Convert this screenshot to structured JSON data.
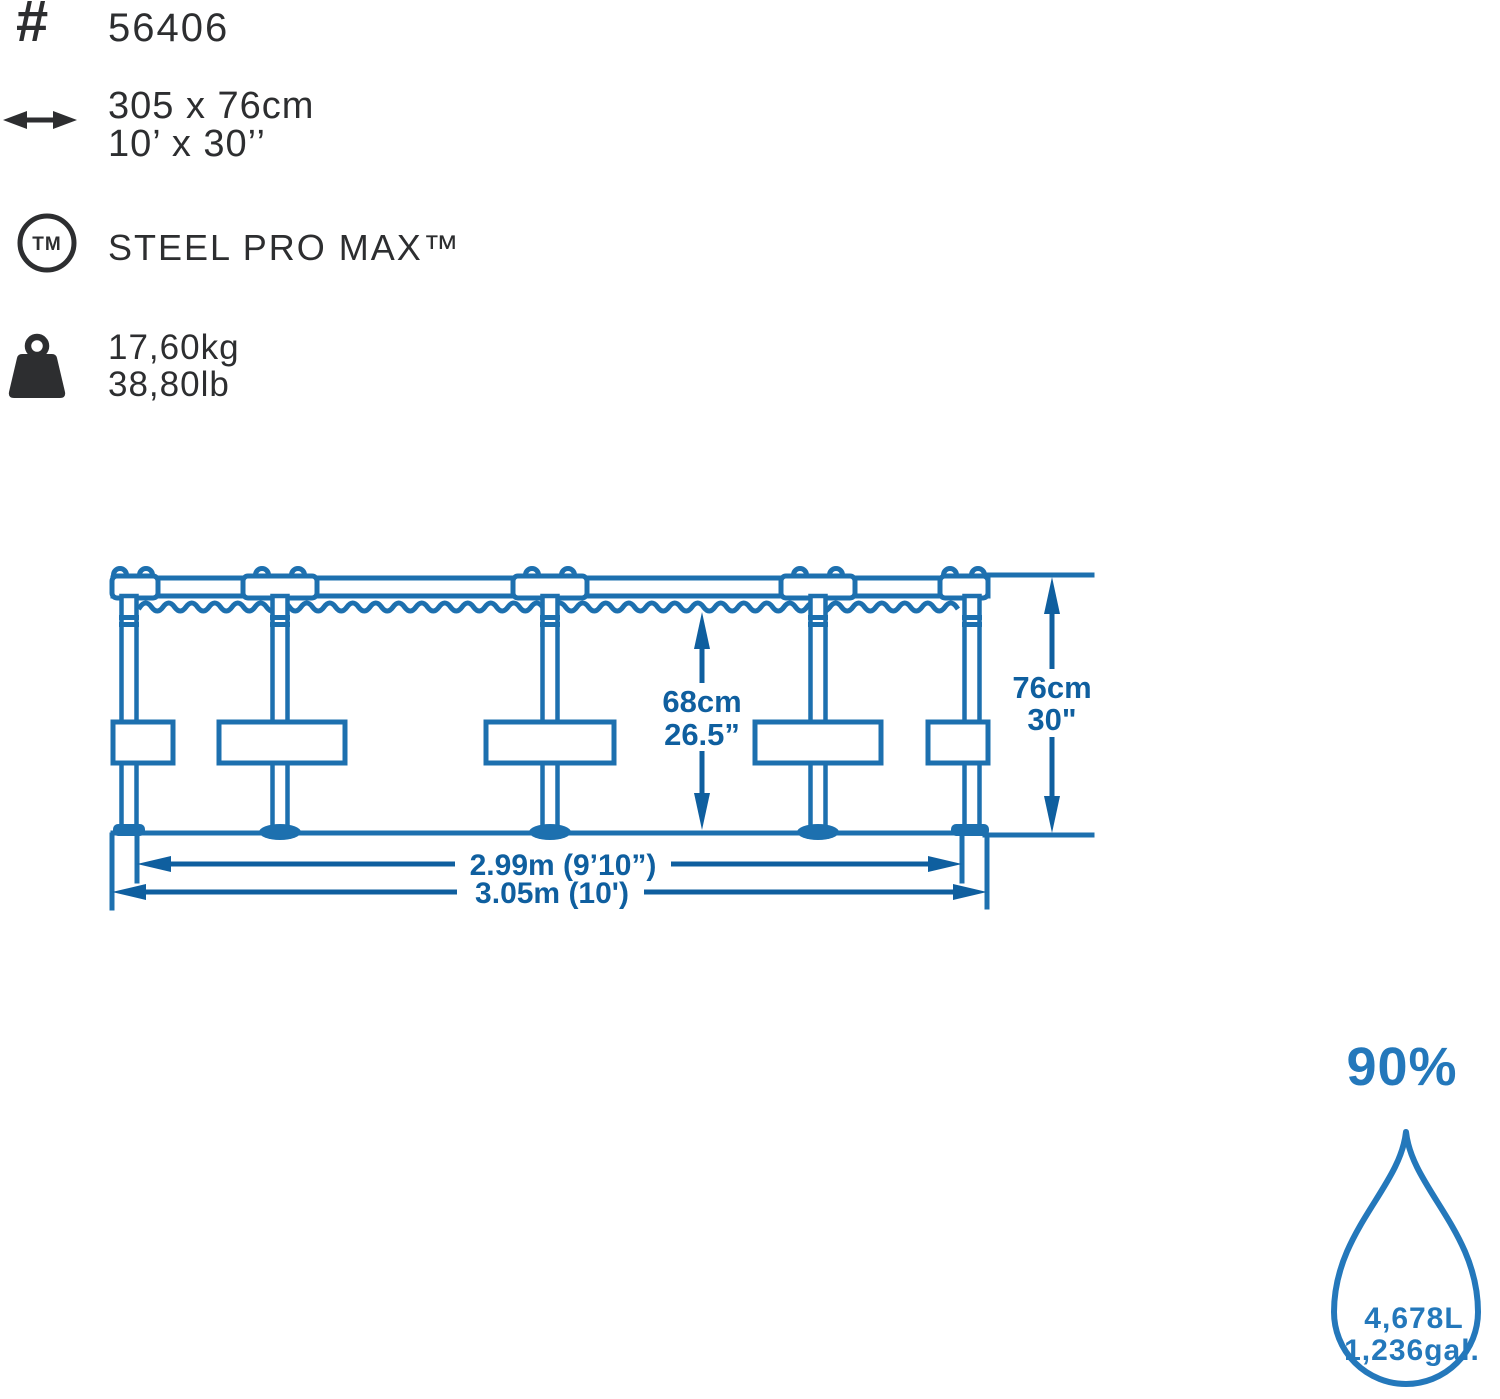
{
  "product": {
    "item_number": "56406",
    "size_metric": "305 x 76cm",
    "size_imperial": "10’ x 30’’",
    "series_name": "STEEL PRO MAX™",
    "weight_metric": "17,60kg",
    "weight_imperial": "38,80lb"
  },
  "diagram": {
    "water_depth_metric": "68cm",
    "water_depth_imperial": "26.5”",
    "wall_height_metric": "76cm",
    "wall_height_imperial": "30\"",
    "inner_diameter_label": "2.99m (9’10”)",
    "outer_diameter_label": "3.05m (10')"
  },
  "capacity": {
    "fill_level": "90%",
    "volume_metric": "4,678L",
    "volume_imperial": "1,236gal."
  },
  "icons": {
    "hash_glyph": "#",
    "trademark_glyph": "TM"
  },
  "colors": {
    "ink": "#2d2e30",
    "frame_blue": "#1d70af",
    "dimension_blue": "#0f5f9f",
    "capacity_blue": "#2478bb"
  }
}
